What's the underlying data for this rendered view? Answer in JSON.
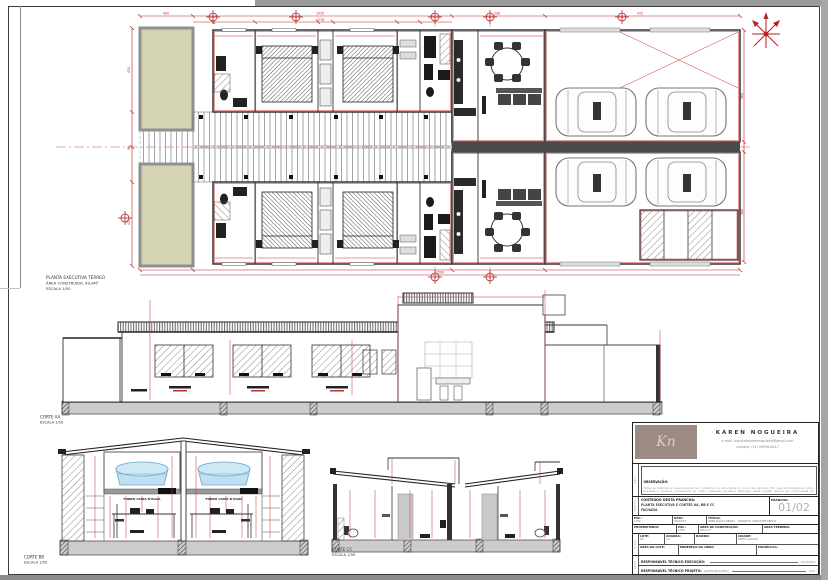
{
  "plan": {
    "caption1": "PLANTA EXECUTIVA TÉRREO",
    "caption2": "ÁREA CONSTRUÍDA: 99,9M²",
    "caption3": "ESCALA 1/50",
    "dims": {
      "a": "420",
      "b": "1035",
      "c": "298",
      "d": "415",
      "e": "1278",
      "f": "2590",
      "g": "415",
      "h": "90",
      "i": "560"
    }
  },
  "corte_aa": {
    "caption1": "CORTE AA",
    "caption2": "ESCALA 1/50"
  },
  "corte_bb": {
    "caption1": "CORTE BB",
    "caption2": "ESCALA 1/50",
    "tank_label": "FORRO CAIXA D'ÁGUA"
  },
  "corte_cc": {
    "caption1": "CORTE CC",
    "caption2": "ESCALA 1/50"
  },
  "titleblock": {
    "logo_initials": "Kn",
    "architect_name": "KAREN NOGUEIRA",
    "contact_email": "e-mail: arquitetakarennogueira@gmail.com",
    "contact_phone": "contato: (31) 99938-6017",
    "strip_obs": "OBS.",
    "strip_dados": "DADOS",
    "strip_local": "LOCAL",
    "strip_resp": "RESP.",
    "observacao_label": "OBSERVAÇÃO:",
    "observacao_text": "Todas as medidas e níveis deverão ser conferidos na obra antes do início dos serviços. Em caso de divergência entre medidas e desenho, prevalecem as cotas indicadas. Qualquer alteração deste projeto deverá ser comunicada ao responsável técnico. Este projeto deverá ser executado conforme as normas técnicas vigentes e a legislação municipal.",
    "conteudo_label": "CONTEÚDO DESTA PRANCHA:",
    "conteudo_line1": "PLANTA EXECUTIVA E CORTES AA, BB E CC",
    "conteudo_line2": "FACHADA",
    "prancha_label": "PRANCHA:",
    "prancha_value": "01/02",
    "esc_label": "ESC.:",
    "esc_value": "1/50",
    "data_label": "DATA:",
    "data_value": "05/2023",
    "titulo_label": "TÍTULO:",
    "titulo_value": "AMPLIAÇÃO RESID. - PROJETO ARQUITETÔNICO",
    "proprietario_label": "PROPRIETÁRIO:",
    "proprietario_value": "",
    "esc2_label": "ESC.:",
    "esc2_value": "1/50",
    "area_construcao_label": "ÁREA DE CONSTRUÇÃO:",
    "area_construcao_value": "99,9 m²",
    "area_terreno_label": "ÁREA TERRENO:",
    "area_terreno_value": "",
    "lote_label": "LOTE:",
    "lote_value": "05",
    "quadra_label": "QUADRA:",
    "quadra_value": "12",
    "bairro_label": "BAIRRO:",
    "bairro_value": "",
    "cidade_label": "CIDADE:",
    "cidade_value": "SETE LAGOAS",
    "area_lote_label": "ÁREA DO LOTE:",
    "area_lote_value": "",
    "endereco_label": "ENDEREÇO DA OBRA:",
    "endereco_value": "",
    "matricula_label": "MATRÍCULA:",
    "matricula_value": "",
    "resp_exec_label": "RESPONSÁVEL TÉCNICO EXECUÇÃO:",
    "resp_exec_name": "",
    "resp_exec_right": "CAU/CREA:",
    "resp_proj_label": "RESPONSÁVEL TÉCNICO PROJETO:",
    "resp_proj_name": "KAREN NOGUEIRA",
    "resp_proj_right": "CAU:"
  }
}
